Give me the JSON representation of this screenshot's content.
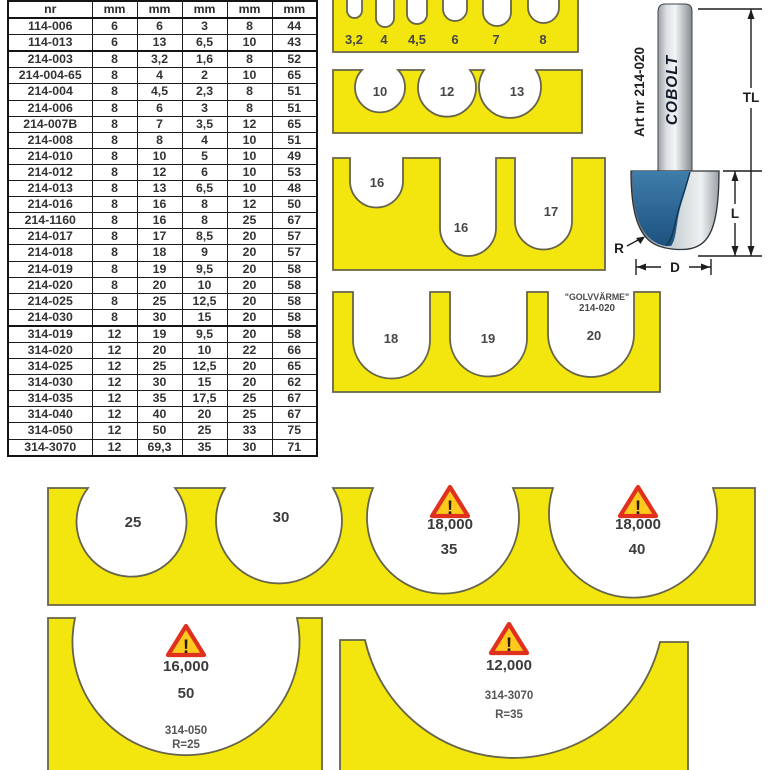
{
  "colors": {
    "yellow": "#f2e60e",
    "outline": "#67644a",
    "warn_red": "#e0301e",
    "warn_fill": "#ffc91e",
    "blue": "#2f6f9f",
    "steel": "#c9ced2"
  },
  "table": {
    "headers": [
      "nr",
      "mm",
      "mm",
      "mm",
      "mm",
      "mm"
    ],
    "thick_after": [
      1,
      18
    ],
    "rows": [
      [
        "114-006",
        "6",
        "6",
        "3",
        "8",
        "44"
      ],
      [
        "114-013",
        "6",
        "13",
        "6,5",
        "10",
        "43"
      ],
      [
        "214-003",
        "8",
        "3,2",
        "1,6",
        "8",
        "52"
      ],
      [
        "214-004-65",
        "8",
        "4",
        "2",
        "10",
        "65"
      ],
      [
        "214-004",
        "8",
        "4,5",
        "2,3",
        "8",
        "51"
      ],
      [
        "214-006",
        "8",
        "6",
        "3",
        "8",
        "51"
      ],
      [
        "214-007B",
        "8",
        "7",
        "3,5",
        "12",
        "65"
      ],
      [
        "214-008",
        "8",
        "8",
        "4",
        "10",
        "51"
      ],
      [
        "214-010",
        "8",
        "10",
        "5",
        "10",
        "49"
      ],
      [
        "214-012",
        "8",
        "12",
        "6",
        "10",
        "53"
      ],
      [
        "214-013",
        "8",
        "13",
        "6,5",
        "10",
        "48"
      ],
      [
        "214-016",
        "8",
        "16",
        "8",
        "12",
        "50"
      ],
      [
        "214-1160",
        "8",
        "16",
        "8",
        "25",
        "67"
      ],
      [
        "214-017",
        "8",
        "17",
        "8,5",
        "20",
        "57"
      ],
      [
        "214-018",
        "8",
        "18",
        "9",
        "20",
        "57"
      ],
      [
        "214-019",
        "8",
        "19",
        "9,5",
        "20",
        "58"
      ],
      [
        "214-020",
        "8",
        "20",
        "10",
        "20",
        "58"
      ],
      [
        "214-025",
        "8",
        "25",
        "12,5",
        "20",
        "58"
      ],
      [
        "214-030",
        "8",
        "30",
        "15",
        "20",
        "58"
      ],
      [
        "314-019",
        "12",
        "19",
        "9,5",
        "20",
        "58"
      ],
      [
        "314-020",
        "12",
        "20",
        "10",
        "22",
        "66"
      ],
      [
        "314-025",
        "12",
        "25",
        "12,5",
        "20",
        "65"
      ],
      [
        "314-030",
        "12",
        "30",
        "15",
        "20",
        "62"
      ],
      [
        "314-035",
        "12",
        "35",
        "17,5",
        "25",
        "67"
      ],
      [
        "314-040",
        "12",
        "40",
        "20",
        "25",
        "67"
      ],
      [
        "314-050",
        "12",
        "50",
        "25",
        "33",
        "75"
      ],
      [
        "314-3070",
        "12",
        "69,3",
        "35",
        "30",
        "71"
      ]
    ]
  },
  "gauges": {
    "slot_block": {
      "labels": [
        "3,2",
        "4",
        "4,5",
        "6",
        "7",
        "8"
      ]
    },
    "block2": {
      "labels": [
        "10",
        "12",
        "13"
      ]
    },
    "block3": {
      "labels": [
        "16",
        "16",
        "17"
      ]
    },
    "block4": {
      "labels": [
        "18",
        "19",
        "20"
      ],
      "note_line1": "\"GOLVVÄRME\"",
      "note_line2": "214-020"
    },
    "big_block": {
      "label_25": "25",
      "label_30": "30",
      "label_35": "35",
      "label_40": "40",
      "rpm_35": "18,000",
      "rpm_40": "18,000"
    },
    "block50": {
      "rpm": "16,000",
      "size": "50",
      "art": "314-050",
      "radius": "R=25"
    },
    "block3070": {
      "rpm": "12,000",
      "art": "314-3070",
      "radius": "R=35"
    }
  },
  "bit": {
    "art": "Art nr 214-020",
    "brand": "COBOLT",
    "dim_tl": "TL",
    "dim_l": "L",
    "dim_d": "D",
    "dim_r": "R"
  },
  "warning": {
    "mark": "!"
  }
}
